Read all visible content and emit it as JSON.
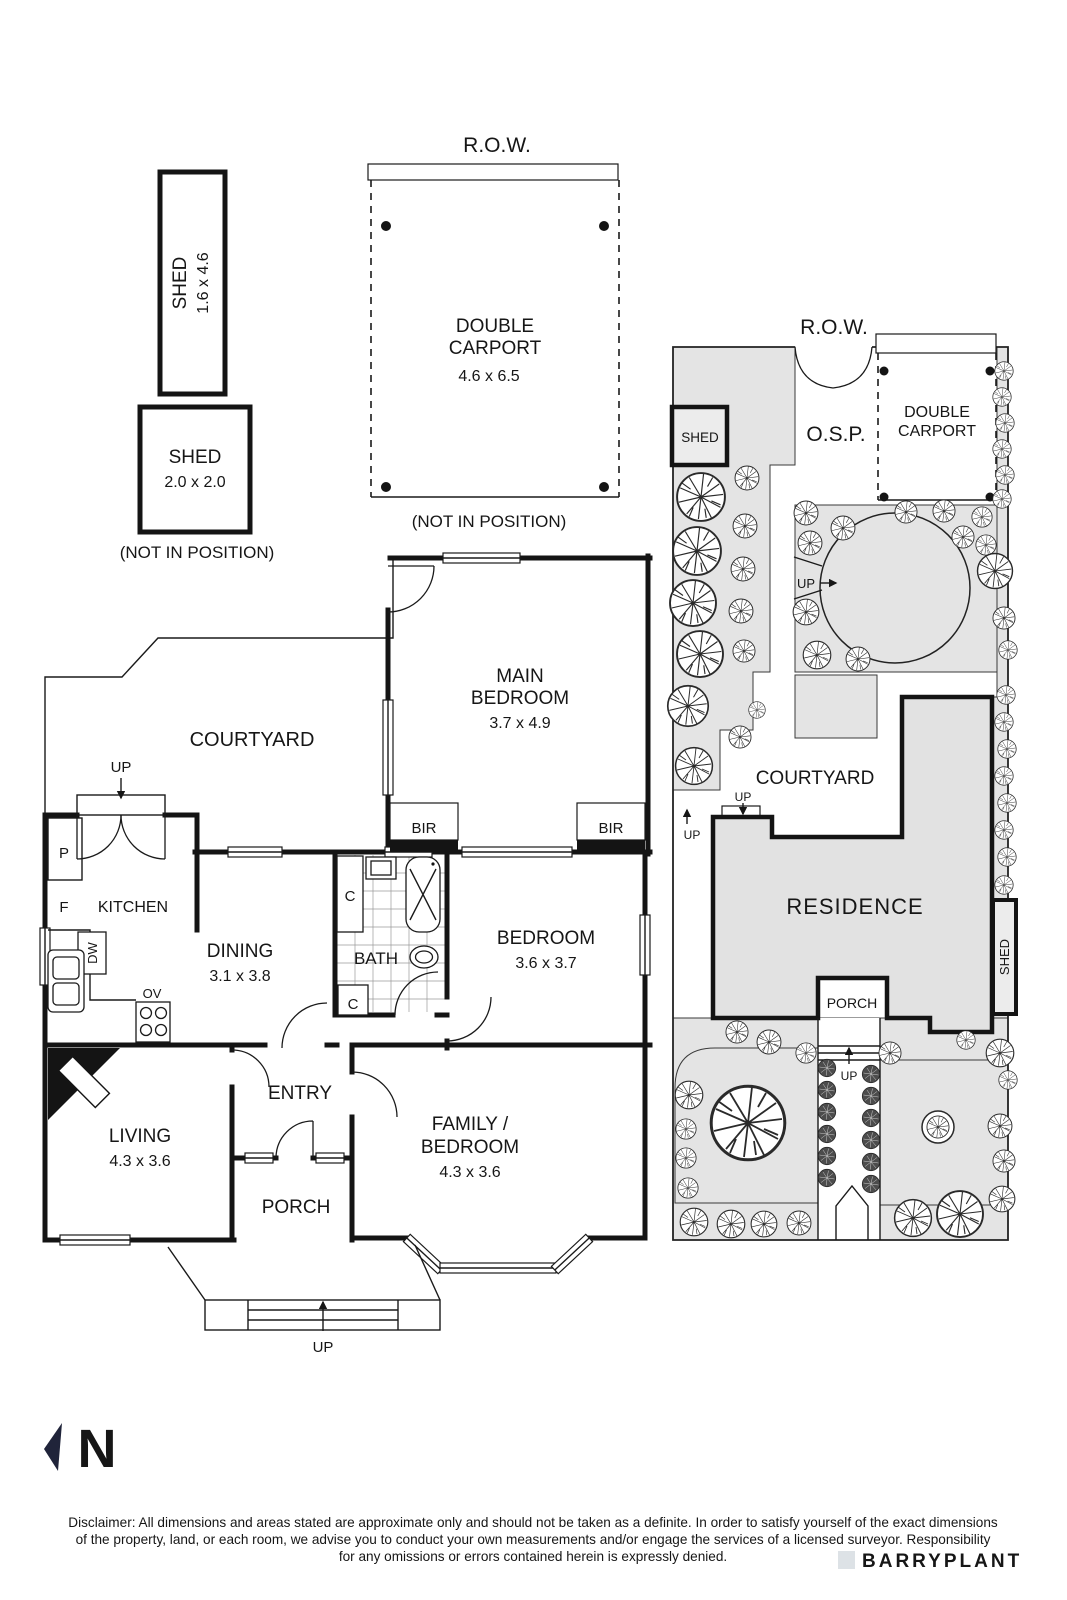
{
  "colors": {
    "line": "#161616",
    "ground_gray": "#e4e4e4",
    "residence_gray": "#e2e2e2",
    "navy": "#20243a",
    "watermark": "#e0e5e9"
  },
  "detached": {
    "shed_tall": {
      "name": "SHED",
      "dims": "1.6 x 4.6"
    },
    "shed_small": {
      "name": "SHED",
      "dims": "2.0 x 2.0"
    },
    "not_in_position_sheds": "(NOT IN POSITION)",
    "row_label": "R.O.W.",
    "carport": {
      "l1": "DOUBLE",
      "l2": "CARPORT",
      "dims": "4.6 x 6.5"
    },
    "not_in_position_carport": "(NOT IN POSITION)"
  },
  "floor_plan": {
    "courtyard": "COURTYARD",
    "up_rear": "UP",
    "main_bedroom": {
      "l1": "MAIN",
      "l2": "BEDROOM",
      "dims": "3.7 x 4.9"
    },
    "bir_left": "BIR",
    "bir_right": "BIR",
    "pantry": "P",
    "fridge": "F",
    "kitchen": "KITCHEN",
    "dishwasher": "DW",
    "oven": "OV",
    "dining": {
      "l1": "DINING",
      "dims": "3.1 x 3.8"
    },
    "closet_upper": "C",
    "closet_lower": "C",
    "bath": "BATH",
    "bedroom": {
      "l1": "BEDROOM",
      "dims": "3.6 x 3.7"
    },
    "entry": "ENTRY",
    "living": {
      "l1": "LIVING",
      "dims": "4.3 x 3.6"
    },
    "family": {
      "l1": "FAMILY /",
      "l2": "BEDROOM",
      "dims": "4.3 x 3.6"
    },
    "porch": "PORCH",
    "up_front": "UP"
  },
  "site_plan": {
    "row_label": "R.O.W.",
    "shed_rear": "SHED",
    "osp": "O.S.P.",
    "carport": {
      "l1": "DOUBLE",
      "l2": "CARPORT"
    },
    "up_circle": "UP",
    "courtyard": "COURTYARD",
    "up_court": "UP",
    "up_side": "UP",
    "residence": "RESIDENCE",
    "porch": "PORCH",
    "shed_side": "SHED",
    "up_path": "UP"
  },
  "compass": {
    "n": "N"
  },
  "footer": {
    "line1": "Disclaimer: All dimensions and areas stated are approximate only and should not be taken as a definite. In order to satisfy yourself of the exact dimensions",
    "line2": "of the property, land, or each room, we advise you to conduct your own measurements and/or engage the services of a licensed surveyor. Responsibility",
    "line3": "for any omissions or errors contained herein is expressly denied.",
    "watermark": "BARRYPLANT"
  }
}
